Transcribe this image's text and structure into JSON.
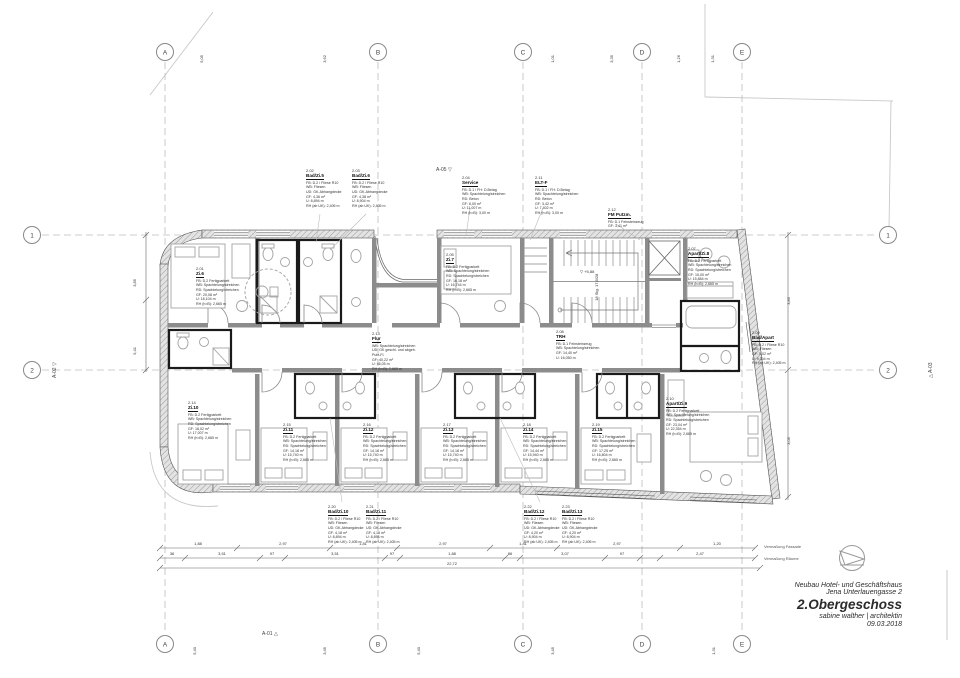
{
  "title_block": {
    "line1": "Neubau Hotel- und Geschäftshaus",
    "line2": "Jena Unterlauengasse 2",
    "line3": "2.Obergeschoss",
    "line4": "sabine walther | architektin",
    "line5": "09.03.2018"
  },
  "grid": {
    "cols": [
      "A",
      "B",
      "C",
      "D",
      "E"
    ],
    "rows": [
      "1",
      "2"
    ]
  },
  "top_ticks": [
    "5,05",
    "3,62",
    "1,01",
    "3,35",
    "1,26",
    "1,31"
  ],
  "bottom_ticks": [
    "5,40",
    "3,45",
    "5,40",
    "3,45",
    "1,31"
  ],
  "side_dims": {
    "left": [
      "3,85",
      "5,41"
    ],
    "right": [
      "3,85",
      "3,05"
    ]
  },
  "markers": {
    "a01": "A-01 △",
    "a02": "A-02 ▽",
    "a03": "△ A-03",
    "a05": "A-05 ▽",
    "level": "▽ +5,88",
    "stair_note": "18 Stg. 17,6/28",
    "total": "22,72",
    "verm_fassade": "Vermaßung Fassade",
    "verm_raeume": "Vermaßung Räume"
  },
  "dims_fassade": [
    "1,88",
    "2,97",
    "1,81",
    "2,97",
    "1,81",
    "2,97",
    "1,20"
  ],
  "dims_raeume": [
    "36",
    "3,51",
    "97",
    "3,51",
    "97",
    "1,88",
    "86",
    "3,07",
    "97",
    "2,47"
  ],
  "rooms": [
    {
      "number": "2.01",
      "name": "Zi.6",
      "props": "FB: D.2 Fertigparkett\nWB: Spachtelung/streichen\nRD: Spachtelung/streichen\nGF: 20,08 m²\nU: 18,104 m\nRH (h≈B): 2,665 m"
    },
    {
      "number": "2.02",
      "name": "Bad/Zi.5",
      "props": "FB: D.2 / Fliese R10\nWB: Fliesen\nUD: GK-Abhangdecke\nGF: 4,36 m²\nU: 8,894 m\nRH (ab UK): 2,405 m"
    },
    {
      "number": "2.03",
      "name": "Bad/Zi.6",
      "props": "FB: D.2 / Fliese R10\nWB: Fliesen\nUD: GK-Abhangdecke\nGF: 4,38 m²\nU: 8,904 m\nRH (ab UK): 2,405 m"
    },
    {
      "number": "2.04",
      "name": "Service",
      "props": "FB: D.1 / FH: D.Belag\nWB: Spachtelung/streichen\nRD: Beton\nGF: 6,00 m²\nU: 11,007 m\nRH (h≈B): 3,00 m"
    },
    {
      "number": "2.11",
      "name": "ELT-F",
      "props": "FB: D.1 / FH: D.Belag\nWB: Spachtelung/streichen\nRD: Beton\nGF: 3,42 m²\nU: 7,402 m\nRH (h≈B): 3,00 m"
    },
    {
      "number": "2.12",
      "name": "FM Putzm.",
      "props": "FB: D.1 Feinsteinzeug\nGF: 3,41 m²"
    },
    {
      "number": "2.05",
      "name": "Zi.7",
      "props": "FB: D.2 Fertigparkett\nWB: Spachtelung/streichen\nRD: Spachtelung/streichen\nGF: 16,18 m²\nU: 16,744 m\nRH (h≈B): 2,665 m"
    },
    {
      "number": "2.07",
      "name": "Apart/Zi.8",
      "props": "FB: D.2 Fertigparkett\nWB: Spachtelung/streichen\nRD: Spachtelung/streichen\nGF: 15,00 m²\nU: 15,884 m\nRH (h≈B): 2,665 m"
    },
    {
      "number": "2.08",
      "name": "TRH",
      "props": "FB: D.1 Feinsteinzeug\nWB: Spachtelung/streichen\nGF: 14,40 m²\nU: 16,050 m"
    },
    {
      "number": "2.13",
      "name": "Flur",
      "props": "WB: Spachtelung/streichen\nUD: GK geschl. und abgeh. Putz-Fl.\nGF: 40,22 m²\nU: 46,05 m\nRH (h≈B): 2,665 m"
    },
    {
      "number": "2.09",
      "name": "Bad/Apart",
      "props": "FB: D.2 / Fliese R10\nWB: Fliesen\nGF: 5,02 m²\nU: 9,304 m\nRH (ab UK): 2,405 m"
    },
    {
      "number": "2.10",
      "name": "Apart/Zi.9",
      "props": "FB: D.2 Fertigparkett\nWB: Spachtelung/streichen\nRD: Spachtelung/streichen\nGF: 23,04 m²\nU: 22,354 m\nRH (h≈B): 2,665 m"
    },
    {
      "number": "2.14",
      "name": "Zi.10",
      "props": "FB: D.2 Fertigparkett\nWB: Spachtelung/streichen\nRD: Spachtelung/streichen\nGF: 18,02 m²\nU: 17,007 m\nRH (h≈B): 2,665 m"
    },
    {
      "number": "2.15",
      "name": "Zi.11",
      "props": "FB: D.2 Fertigparkett\nWB: Spachtelung/streichen\nRD: Spachtelung/streichen\nGF: 14,18 m²\nU: 15,740 m\nRH (h≈B): 2,665 m"
    },
    {
      "number": "2.16",
      "name": "Zi.12",
      "props": "FB: D.2 Fertigparkett\nWB: Spachtelung/streichen\nRD: Spachtelung/streichen\nGF: 14,18 m²\nU: 15,740 m\nRH (h≈B): 2,665 m"
    },
    {
      "number": "2.17",
      "name": "Zi.13",
      "props": "FB: D.2 Fertigparkett\nWB: Spachtelung/streichen\nRD: Spachtelung/streichen\nGF: 14,18 m²\nU: 15,740 m\nRH (h≈B): 2,665 m"
    },
    {
      "number": "2.18",
      "name": "Zi.14",
      "props": "FB: D.2 Fertigparkett\nWB: Spachtelung/streichen\nRD: Spachtelung/streichen\nGF: 14,44 m²\nU: 15,940 m\nRH (h≈B): 2,665 m"
    },
    {
      "number": "2.19",
      "name": "Zi.15",
      "props": "FB: D.2 Fertigparkett\nWB: Spachtelung/streichen\nRD: Spachtelung/streichen\nGF: 17,25 m²\nU: 16,804 m\nRH (h≈B): 2,665 m"
    },
    {
      "number": "2.20",
      "name": "Bad/Zi.10",
      "props": "FB: D.2 / Fliese R10\nWB: Fliesen\nUD: GK-Abhangdecke\nGF: 4,18 m²\nU: 8,894 m\nRH (ab UK): 2,405 m"
    },
    {
      "number": "2.21",
      "name": "Bad/Zi.11",
      "props": "FB: D.2 / Fliese R10\nWB: Fliesen\nUD: GK-Abhangdecke\nGF: 4,18 m²\nU: 8,894 m\nRH (ab UK): 2,405 m"
    },
    {
      "number": "2.22",
      "name": "Bad/Zi.12",
      "props": "FB: D.2 / Fliese R10\nWB: Fliesen\nUD: GK-Abhangdecke\nGF: 4,20 m²\nU: 8,904 m\nRH (ab UK): 2,405 m"
    },
    {
      "number": "2.23",
      "name": "Bad/Zi.13",
      "props": "FB: D.2 / Fliese R10\nWB: Fliesen\nUD: GK-Abhangdecke\nGF: 4,20 m²\nU: 8,904 m\nRH (ab UK): 2,405 m"
    }
  ]
}
